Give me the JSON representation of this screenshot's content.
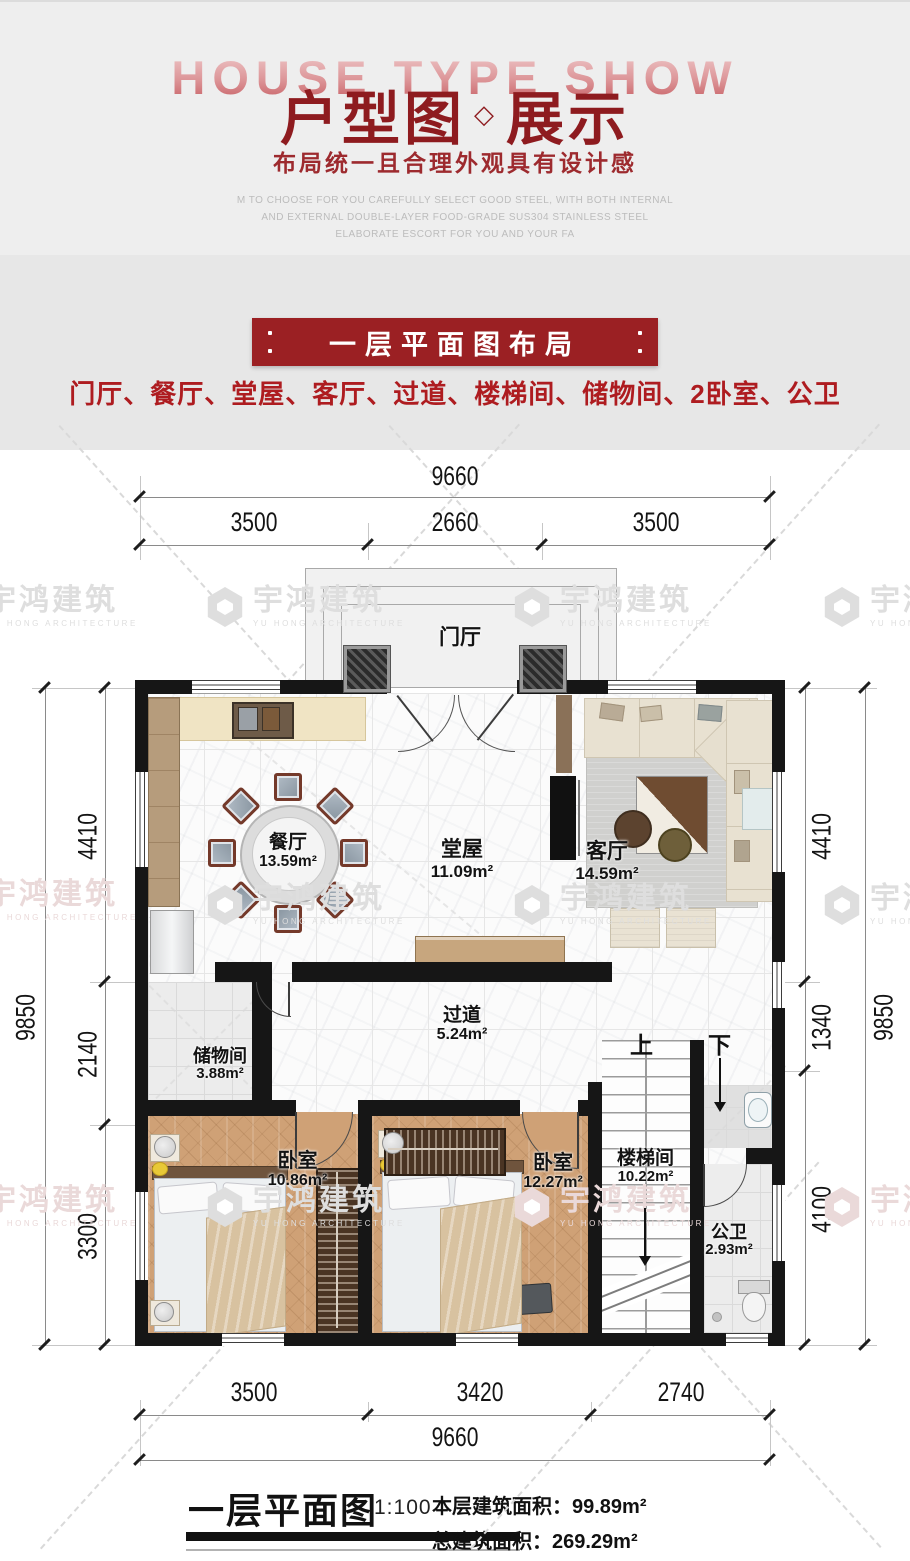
{
  "header": {
    "bg_text": "HOUSE TYPE SHOW",
    "title": "户型图",
    "diamond": "◇",
    "title2": "展示",
    "subtitle": "布局统一且合理外观具有设计感",
    "desc_line1": "M TO CHOOSE FOR YOU CAREFULLY SELECT GOOD STEEL, WITH BOTH INTERNAL",
    "desc_line2": "AND EXTERNAL DOUBLE-LAYER FOOD-GRADE SUS304 STAINLESS STEEL",
    "desc_line3": "ELABORATE ESCORT FOR YOU AND YOUR FA"
  },
  "intro": {
    "banner": "一层平面图布局",
    "room_list": "门厅、餐厅、堂屋、客厅、过道、楼梯间、储物间、2卧室、公卫"
  },
  "plan": {
    "entry": "门厅",
    "rooms": {
      "dining": {
        "name": "餐厅",
        "area": "13.59m²"
      },
      "hall": {
        "name": "堂屋",
        "area": "11.09m²"
      },
      "living": {
        "name": "客厅",
        "area": "14.59m²"
      },
      "corridor": {
        "name": "过道",
        "area": "5.24m²"
      },
      "storage": {
        "name": "储物间",
        "area": "3.88m²"
      },
      "bedroom1": {
        "name": "卧室",
        "area": "10.86m²"
      },
      "bedroom2": {
        "name": "卧室",
        "area": "12.27m²"
      },
      "stairs": {
        "name": "楼梯间",
        "area": "10.22m²"
      },
      "bath": {
        "name": "公卫",
        "area": "2.93m²"
      }
    },
    "stair_up": "上",
    "stair_down": "下",
    "dims": {
      "top_total": "9660",
      "top_segs": [
        "3500",
        "2660",
        "3500"
      ],
      "bottom_segs": [
        "3500",
        "3420",
        "2740"
      ],
      "bottom_total": "9660",
      "left_outer": "9850",
      "left_segs": [
        "4410",
        "2140",
        "3300"
      ],
      "right_outer": "9850",
      "right_segs": [
        "4410",
        "1340",
        "4100"
      ]
    }
  },
  "legend": {
    "title": "一层平面图",
    "scale": "1:100",
    "row1_label": "本层建筑面积：",
    "row1_value": "99.89m²",
    "row2_label": "总建筑面积：",
    "row2_value": "269.29m²"
  },
  "watermark": {
    "text": "宇鸿建筑",
    "subtext": "YU HONG ARCHITECTURE"
  },
  "colors": {
    "accent_red": "#9b2023",
    "list_red": "#ae1c20",
    "title_red": "#8e1b1f",
    "wall": "#161616"
  }
}
